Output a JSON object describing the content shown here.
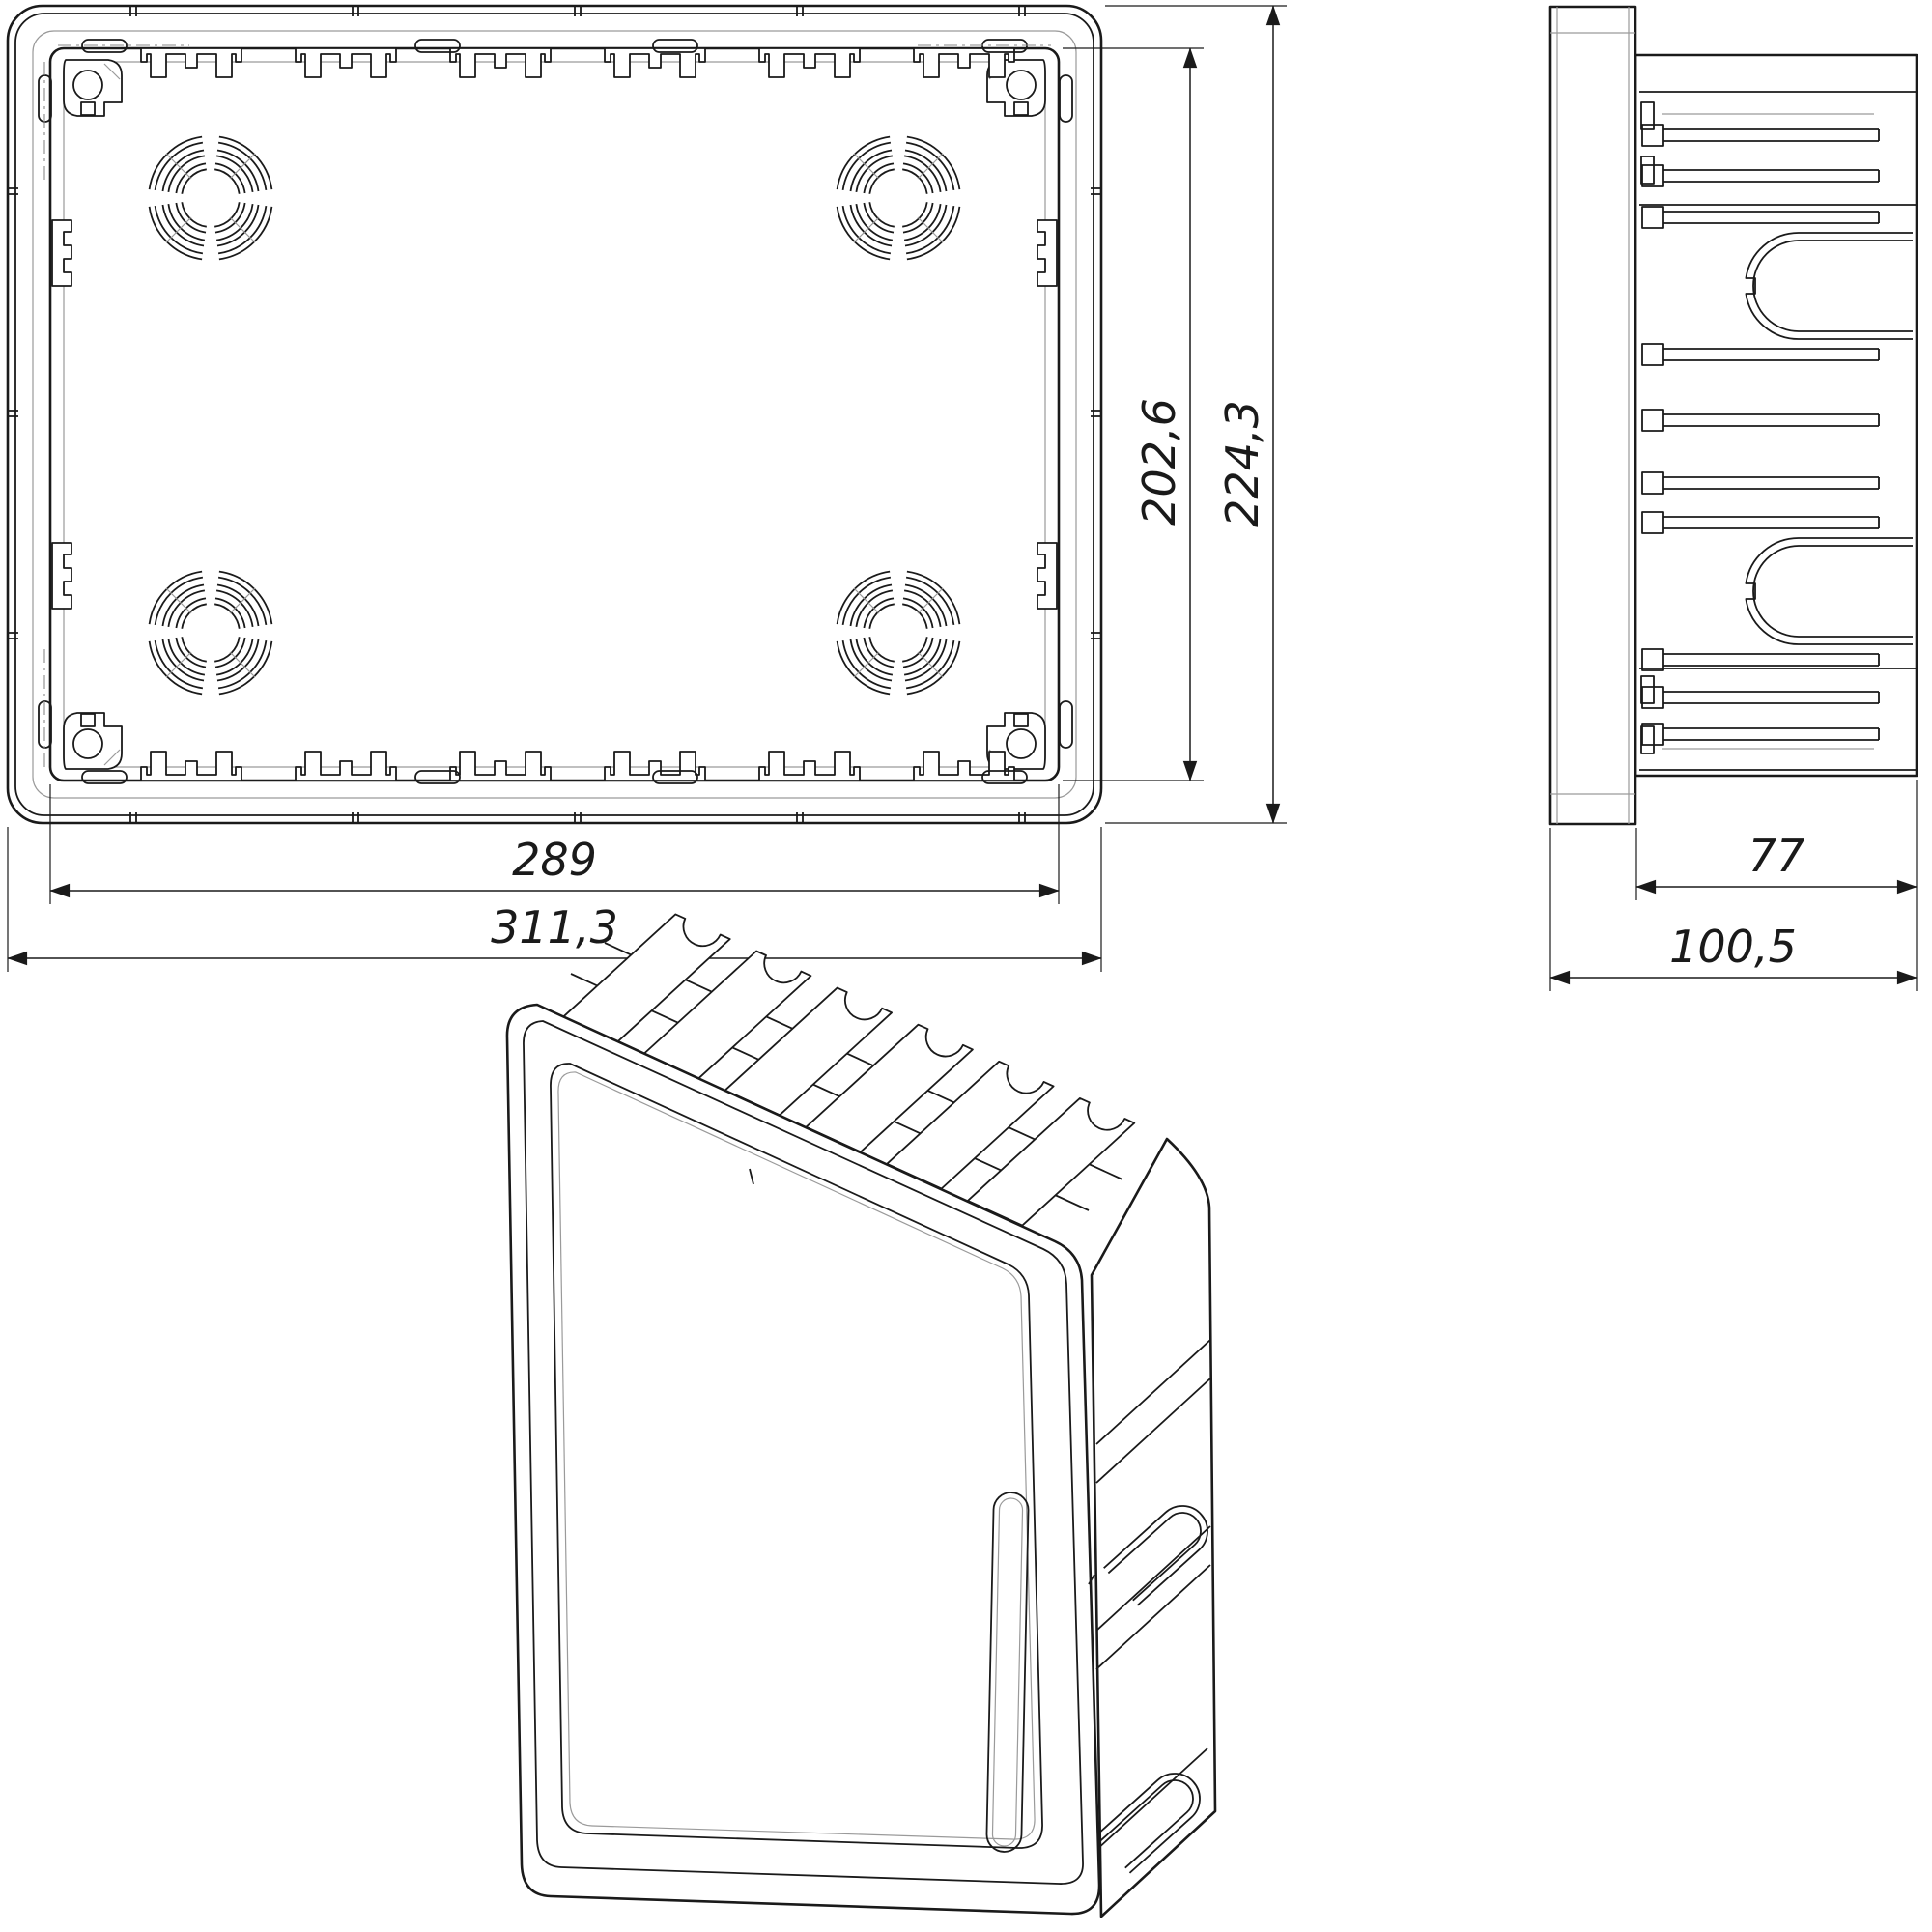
{
  "drawing": {
    "type": "technical-drawing",
    "subject": "flush-mount distribution box",
    "views": {
      "front": {
        "name": "front view"
      },
      "side": {
        "name": "side view"
      },
      "iso": {
        "name": "isometric view"
      }
    },
    "dimensions": {
      "front_inner_height": "202,6",
      "front_outer_height": "224,3",
      "front_inner_width": "289",
      "front_outer_width": "311,3",
      "side_body_depth": "77",
      "side_total_depth": "100,5"
    },
    "colors": {
      "line": "#1a1a1a",
      "thin_line": "#9a9a9a",
      "background": "#ffffff"
    }
  }
}
